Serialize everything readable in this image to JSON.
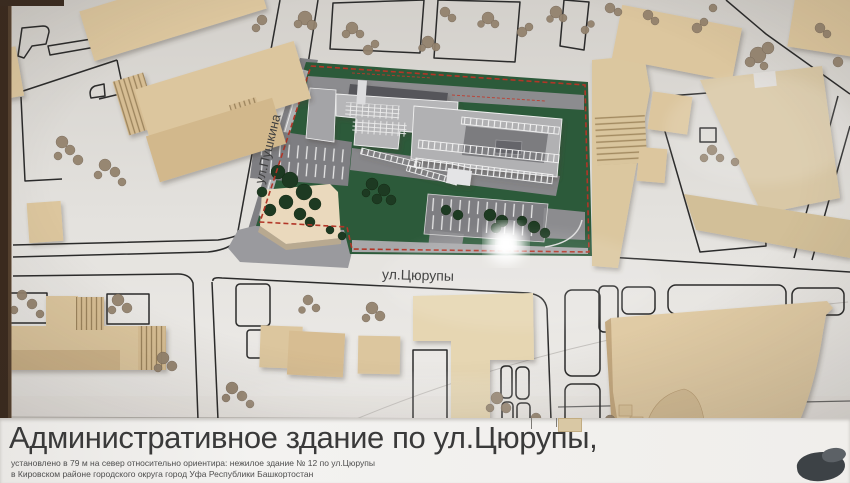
{
  "board": {
    "title": "Административное здание по ул.Цюрупы,",
    "subtitle_line1": "установлено в 79 м на север относительно ориентира: нежилое здание № 12 по ул.Цюрупы",
    "subtitle_line2": "в Кировском районе городского округа город Уфа Республики Башкортостан"
  },
  "street_labels": {
    "pushkina": "ул.Пушкина",
    "tsyurupy": "ул.Цюрупы"
  },
  "colors": {
    "base": "#dedbd6",
    "wood": "#dcc69e",
    "wood_dark": "#c9b088",
    "site_green": "#2c5a3a",
    "road_gray": "#87878a",
    "building_gray": "#b1b1b3",
    "building_trim": "#f1f1f1",
    "outline": "#2b2b2b",
    "red_dash": "#b23527",
    "tree_model": "#1d3a22",
    "lichen": "#93826d",
    "frame": "#3a2a1e",
    "title_text": "#3a3a3a"
  }
}
